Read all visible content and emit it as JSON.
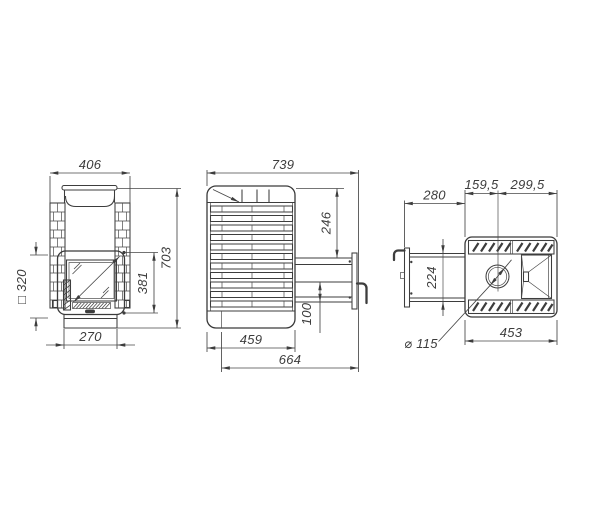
{
  "drawing": {
    "type": "stove-three-view-dimension-drawing",
    "colors": {
      "line": "#3d3d3d",
      "text": "#3c3c3c",
      "background": "#ffffff"
    },
    "views": {
      "front": {
        "dims": {
          "overall_width": "406",
          "overall_height": "703",
          "door_opening_height": "381",
          "stone_cage_square": "□ 320",
          "base_width": "270"
        }
      },
      "side": {
        "dims": {
          "overall_depth": "739",
          "tunnel_top_offset": "246",
          "tunnel_bottom_height": "100",
          "body_depth": "459",
          "depth_with_tunnel": "664"
        }
      },
      "top": {
        "dims": {
          "chimney_offset_front": "159,5",
          "chimney_offset_back": "299,5",
          "tunnel_length": "280",
          "tunnel_width": "224",
          "chimney_diameter": "⌀ 115",
          "body_width": "453"
        }
      }
    }
  }
}
